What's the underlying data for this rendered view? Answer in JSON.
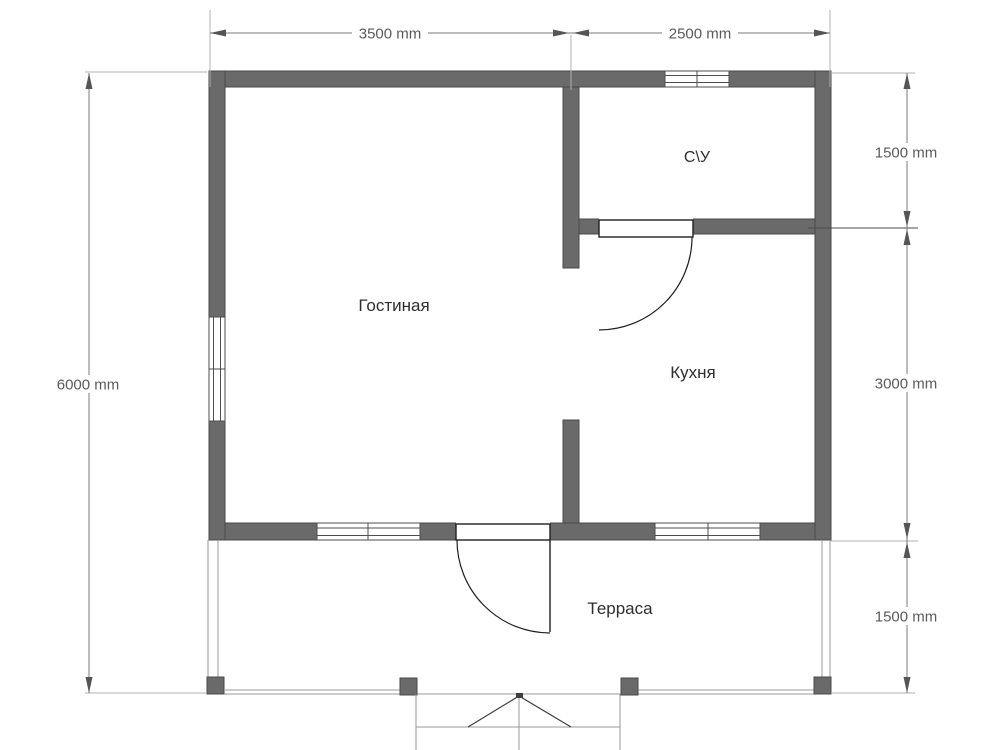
{
  "plan": {
    "title": "floor-plan",
    "rooms": [
      {
        "id": "living-room",
        "label": "Гостиная"
      },
      {
        "id": "kitchen",
        "label": "Кухня"
      },
      {
        "id": "bathroom",
        "label": "С\\У"
      },
      {
        "id": "terrace",
        "label": "Терраса"
      }
    ],
    "dimensions": {
      "top": [
        {
          "label": "3500 mm"
        },
        {
          "label": "2500 mm"
        }
      ],
      "left": [
        {
          "label": "6000 mm"
        }
      ],
      "right": [
        {
          "label": "1500 mm"
        },
        {
          "label": "3000 mm"
        },
        {
          "label": "1500 mm"
        }
      ]
    },
    "colors": {
      "wall": "#6a6a6a",
      "wall_edge": "#4a4a4a",
      "dimension": "#7a7a7a",
      "dim_text": "#5a5a5a",
      "room_text": "#2e2e2e",
      "background": "#ffffff"
    }
  }
}
